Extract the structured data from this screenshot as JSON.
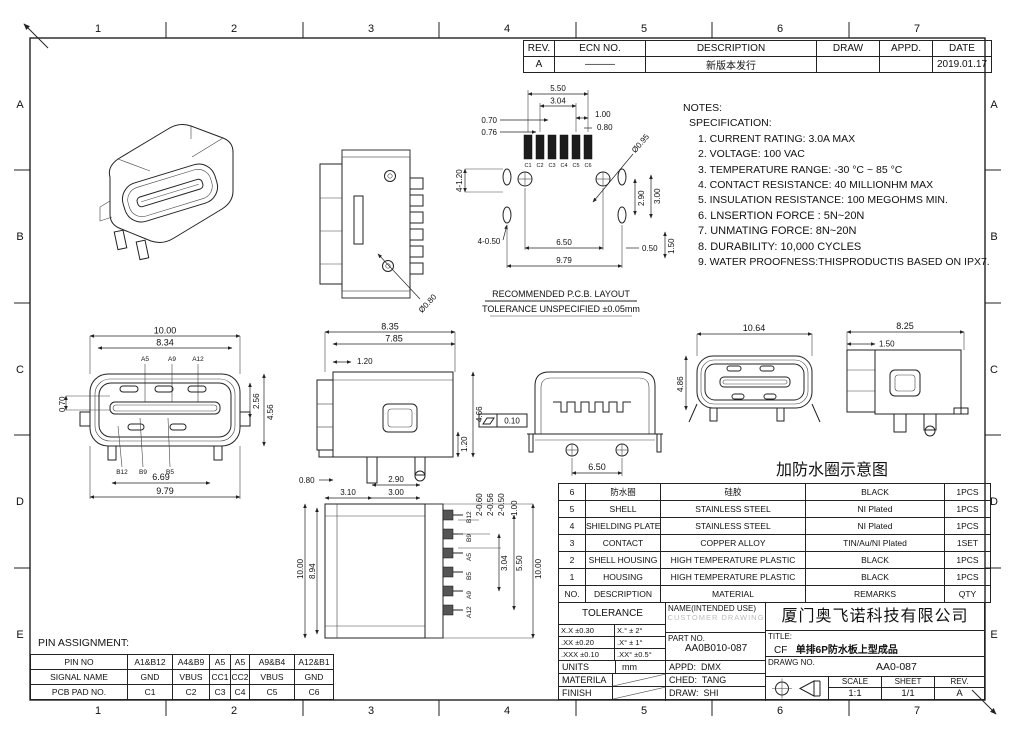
{
  "frame": {
    "cols": [
      "1",
      "2",
      "3",
      "4",
      "5",
      "6",
      "7"
    ],
    "rows": [
      "A",
      "B",
      "C",
      "D",
      "E"
    ]
  },
  "revision": {
    "headers": [
      "REV.",
      "ECN  NO.",
      "DESCRIPTION",
      "DRAW",
      "APPD.",
      "DATE"
    ],
    "row": {
      "rev": "A",
      "ecn": "———",
      "description": "新版本发行",
      "draw": "",
      "appd": "",
      "date": "2019.01.17"
    }
  },
  "notes": {
    "title": "NOTES:",
    "subtitle": "SPECIFICATION:",
    "items": [
      "1. CURRENT RATING: 3.0A MAX",
      "2. VOLTAGE: 100 VAC",
      "3. TEMPERATURE RANGE: -30 °C ~ 85 °C",
      "4. CONTACT RESISTANCE: 40 MILLIONHM MAX",
      "5. INSULATION RESISTANCE: 100 MEGOHMS MIN.",
      "6.  LNSERTION FORCE : 5N~20N",
      "7.  UNMATING FORCE: 8N~20N",
      "8.  DURABILITY:   10,000 CYCLES",
      "9. WATER PROOFNESS:THISPRODUCTIS BASED ON IPX7."
    ]
  },
  "pcb": {
    "caption1": "RECOMMENDED   P.C.B.  LAYOUT",
    "caption2": "TOLERANCE  UNSPECIFIED  ±0.05mm",
    "pads": [
      "C1",
      "C2",
      "C3",
      "C4",
      "C5",
      "C6"
    ],
    "d550": "5.50",
    "d304": "3.04",
    "d100": "1.00",
    "d080": "0.80",
    "d070": "0.70",
    "d076": "0.76",
    "d095": "Ø0.95",
    "d4120": "4-1.20",
    "d4050": "4-0.50",
    "d650": "6.50",
    "d979": "9.79",
    "d290": "2.90",
    "d300": "3.00",
    "d050": "0.50",
    "d150": "1.50"
  },
  "front": {
    "d1000": "10.00",
    "d834": "8.34",
    "d070": "0.70",
    "d256": "2.56",
    "d456": "4.56",
    "d669": "6.69",
    "d979": "9.79",
    "top_pins": [
      "A5",
      "A9",
      "A12"
    ],
    "bottom_pins": [
      "B12",
      "B9",
      "B5"
    ]
  },
  "side": {
    "d835": "8.35",
    "d785": "7.85",
    "d120t": "1.20",
    "d120r": "1.20",
    "d466": "4.66",
    "d080": "0.80",
    "d290": "2.90",
    "d310": "3.10",
    "d300": "3.00"
  },
  "rear": {
    "flat": "0.10",
    "d650": "6.50"
  },
  "water": {
    "caption": "加防水圈示意图",
    "d1064": "10.64",
    "d486": "4.86",
    "d825": "8.25",
    "d150": "1.50"
  },
  "top_view": {
    "d080": "Ø0.80"
  },
  "bottom": {
    "d1000l": "10.00",
    "d894": "8.94",
    "d1000r": "10.00",
    "d2060": "2-0.60",
    "d2056": "2-0.56",
    "d2050": "2-0.50",
    "d100": "1.00",
    "d304": "3.04",
    "d550": "5.50",
    "pins": [
      "B12",
      "B9",
      "A5",
      "B5",
      "A9",
      "A12"
    ]
  },
  "bom": {
    "headers": [
      "NO.",
      "DESCRIPTION",
      "MATERIAL",
      "REMARKS",
      "QTY"
    ],
    "rows": [
      [
        "6",
        "防水圈",
        "硅胶",
        "BLACK",
        "1PCS"
      ],
      [
        "5",
        "SHELL",
        "STAINLESS  STEEL",
        "NI   Plated",
        "1PCS"
      ],
      [
        "4",
        "SHIELDING  PLATE",
        "STAINLESS  STEEL",
        "NI   Plated",
        "1PCS"
      ],
      [
        "3",
        "CONTACT",
        "COPPER  ALLOY",
        "TIN/Au/NI  Plated",
        "1SET"
      ],
      [
        "2",
        "SHELL  HOUSING",
        "HIGH  TEMPERATURE  PLASTIC",
        "BLACK",
        "1PCS"
      ],
      [
        "1",
        "HOUSING",
        "HIGH  TEMPERATURE  PLASTIC",
        "BLACK",
        "1PCS"
      ]
    ]
  },
  "titleblock": {
    "tolerance_label": "TOLERANCE",
    "tol_rows": [
      [
        "X.X    ±0.30",
        "X.°    ± 2°"
      ],
      [
        ".XX    ±0.20",
        ".X°    ± 1°"
      ],
      [
        ".XXX  ±0.10",
        ".XX°  ±0.5°"
      ]
    ],
    "units_label": "UNITS",
    "units": "mm",
    "material_label": "MATERILA",
    "finish_label": "FINISH",
    "name_label": "NAME(INTENDED  USE)",
    "name_watermark": "CUSTOMER DRAWING",
    "part_label": "PART  NO.",
    "part_no": "AA0B010-087",
    "appd_label": "APPD:",
    "appd": "DMX",
    "ched_label": "CHED:",
    "ched": "TANG",
    "draw_label": "DRAW:",
    "draw": "SHI",
    "company": "厦门奥飞诺科技有限公司",
    "title_label": "TITLE:",
    "title_cf": "CF",
    "title_text": "单排6P防水板上型成品",
    "drawg_label": "DRAWG  NO.",
    "drawg_no": "AA0-087",
    "scale_label": "SCALE",
    "scale": "1:1",
    "sheet_label": "SHEET",
    "sheet": "1/1",
    "rev_label": "REV.",
    "rev": "A"
  },
  "pin_table": {
    "label": "PIN  ASSIGNMENT:",
    "rows": [
      [
        "PIN  NO",
        "A1&B12",
        "A4&B9",
        "A5",
        "A5",
        "A9&B4",
        "A12&B1"
      ],
      [
        "SIGNAL  NAME",
        "GND",
        "VBUS",
        "CC1",
        "CC2",
        "VBUS",
        "GND"
      ],
      [
        "PCB  PAD  NO.",
        "C1",
        "C2",
        "C3",
        "C4",
        "C5",
        "C6"
      ]
    ]
  }
}
